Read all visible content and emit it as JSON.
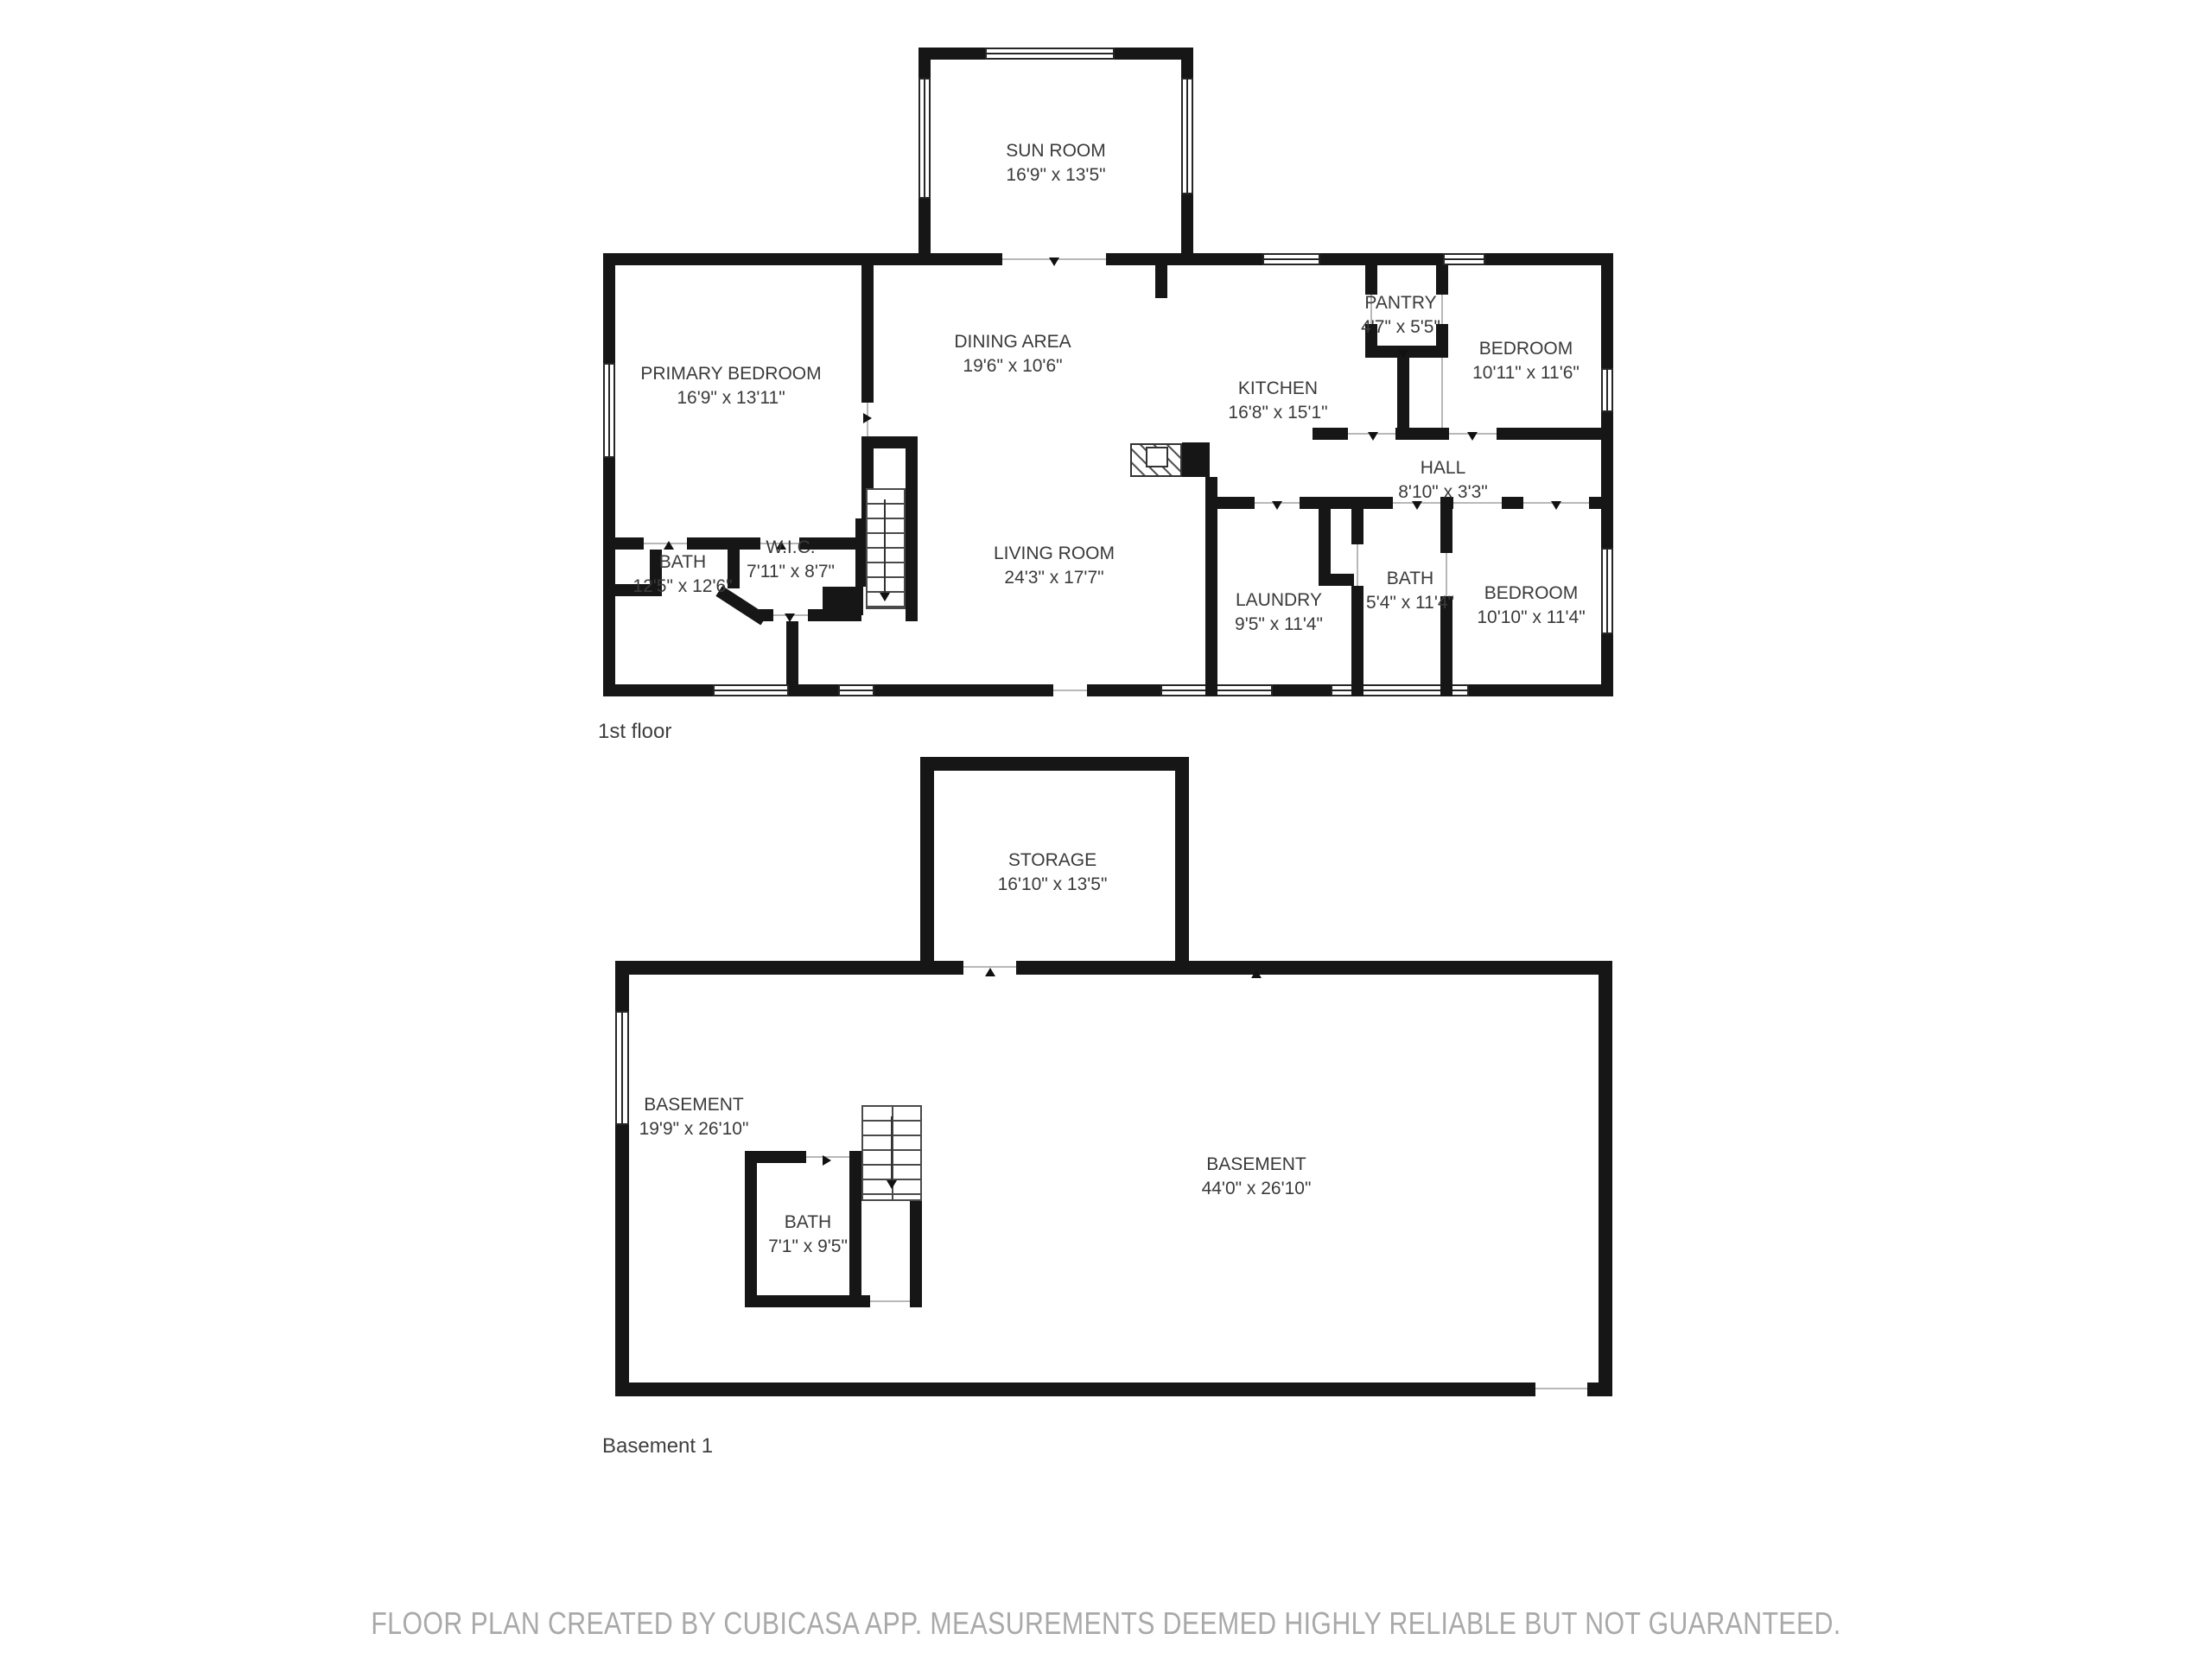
{
  "floor1": {
    "label": "1st floor",
    "rooms": {
      "sun_room": {
        "name": "SUN ROOM",
        "dims": "16'9\" x 13'5\""
      },
      "primary_bedroom": {
        "name": "PRIMARY BEDROOM",
        "dims": "16'9\" x 13'11\""
      },
      "dining_area": {
        "name": "DINING AREA",
        "dims": "19'6\" x 10'6\""
      },
      "kitchen": {
        "name": "KITCHEN",
        "dims": "16'8\" x 15'1\""
      },
      "pantry": {
        "name": "PANTRY",
        "dims": "4'7\" x 5'5\""
      },
      "bedroom_ne": {
        "name": "BEDROOM",
        "dims": "10'11\" x 11'6\""
      },
      "hall": {
        "name": "HALL",
        "dims": "8'10\" x 3'3\""
      },
      "bath_left": {
        "name": "BATH",
        "dims": "12'5\" x 12'6\""
      },
      "wic": {
        "name": "W.I.C.",
        "dims": "7'11\" x 8'7\""
      },
      "living_room": {
        "name": "LIVING ROOM",
        "dims": "24'3\" x 17'7\""
      },
      "laundry": {
        "name": "LAUNDRY",
        "dims": "9'5\" x 11'4\""
      },
      "bath_right": {
        "name": "BATH",
        "dims": "5'4\" x 11'4\""
      },
      "bedroom_se": {
        "name": "BEDROOM",
        "dims": "10'10\" x 11'4\""
      }
    }
  },
  "basement": {
    "label": "Basement 1",
    "rooms": {
      "storage": {
        "name": "STORAGE",
        "dims": "16'10\" x 13'5\""
      },
      "basement_left": {
        "name": "BASEMENT",
        "dims": "19'9\" x 26'10\""
      },
      "basement_main": {
        "name": "BASEMENT",
        "dims": "44'0\" x 26'10\""
      },
      "bath": {
        "name": "BATH",
        "dims": "7'1\" x 9'5\""
      }
    }
  },
  "footer": "FLOOR PLAN CREATED BY CUBICASA APP. MEASUREMENTS DEEMED HIGHLY RELIABLE BUT NOT GUARANTEED.",
  "colors": {
    "wall": "#161616",
    "room_label": "#3a3a3a",
    "floor_label": "#3f3f3f",
    "footer_text": "#a9a9a9"
  },
  "icons": {
    "stairs_direction_arrow": "▼",
    "door_marker": "▲"
  }
}
